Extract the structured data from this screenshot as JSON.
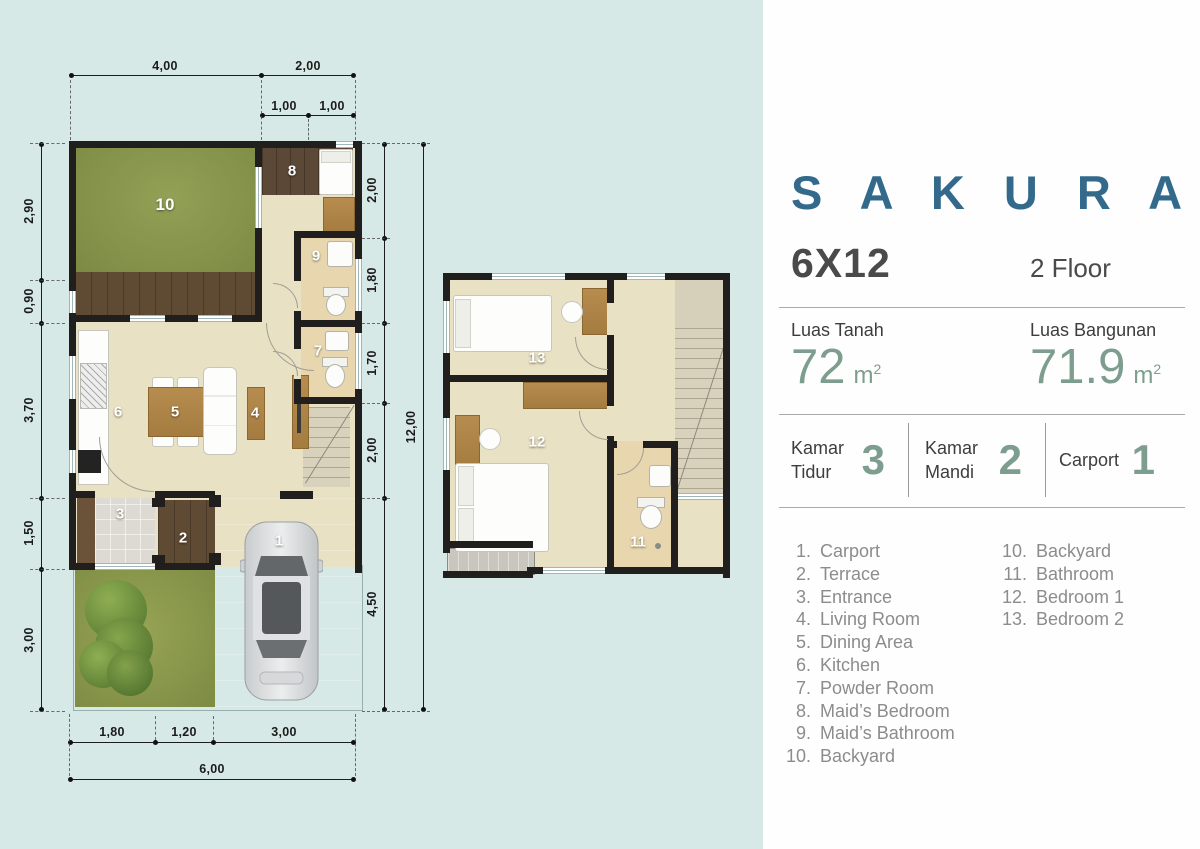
{
  "panel": {
    "title": "S A K U R A",
    "size": "6X12",
    "floor": "2 Floor",
    "land": {
      "label": "Luas Tanah",
      "value": "72",
      "unit": "m",
      "sup": "2"
    },
    "building": {
      "label": "Luas Bangunan",
      "value": "71.9",
      "unit": "m",
      "sup": "2"
    },
    "stats": [
      {
        "label": "Kamar Tidur",
        "value": "3"
      },
      {
        "label": "Kamar Mandi",
        "value": "2"
      },
      {
        "label": "Carport",
        "value": "1"
      }
    ],
    "legend_left": [
      {
        "num": "1.",
        "text": "Carport"
      },
      {
        "num": "2.",
        "text": "Terrace"
      },
      {
        "num": "3.",
        "text": "Entrance"
      },
      {
        "num": "4.",
        "text": "Living Room"
      },
      {
        "num": "5.",
        "text": "Dining Area"
      },
      {
        "num": "6.",
        "text": "Kitchen"
      },
      {
        "num": "7.",
        "text": "Powder Room"
      },
      {
        "num": "8.",
        "text": "Maid’s Bedroom"
      },
      {
        "num": "9.",
        "text": "Maid’s Bathroom"
      },
      {
        "num": "10.",
        "text": "Backyard"
      }
    ],
    "legend_right": [
      {
        "num": "10.",
        "text": "Backyard"
      },
      {
        "num": "11.",
        "text": "Bathroom"
      },
      {
        "num": "12.",
        "text": "Bedroom 1"
      },
      {
        "num": "13.",
        "text": "Bedroom 2"
      }
    ]
  },
  "dimensions": {
    "top_row1": [
      "4,00",
      "2,00"
    ],
    "top_row2": [
      "1,00",
      "1,00"
    ],
    "left_col": [
      "2,90",
      "0,90",
      "3,70",
      "1,50",
      "3,00"
    ],
    "right_col": [
      "2,00",
      "1,80",
      "1,70",
      "2,00",
      "4,50"
    ],
    "right_total": "12,00",
    "bottom_row1": [
      "1,80",
      "1,20",
      "3,00"
    ],
    "bottom_total": "6,00"
  },
  "ground_floor": {
    "backyard": "10",
    "maid_bedroom": "8",
    "maid_bathroom": "9",
    "powder_room": "7",
    "kitchen": "6",
    "dining": "5",
    "living": "4",
    "entrance": "3",
    "terrace": "2",
    "carport": "1"
  },
  "second_floor": {
    "bedroom2": "13",
    "bedroom1": "12",
    "bathroom": "11"
  },
  "colors": {
    "background": "#d7e9e6",
    "accent_blue": "#336a8c",
    "sage_green": "#7d9e8e",
    "text_dark": "#3d3d3d",
    "legend_gray": "#8c8c8c",
    "wall": "#211f1d",
    "backyard_green": "#8a9750",
    "floor_beige": "#e9e1c4",
    "bath_tan": "#e8d7ae",
    "wood_dark": "#5f4a34",
    "wood_light": "#b68c4f",
    "carport_gray": "#bcb8b0"
  }
}
